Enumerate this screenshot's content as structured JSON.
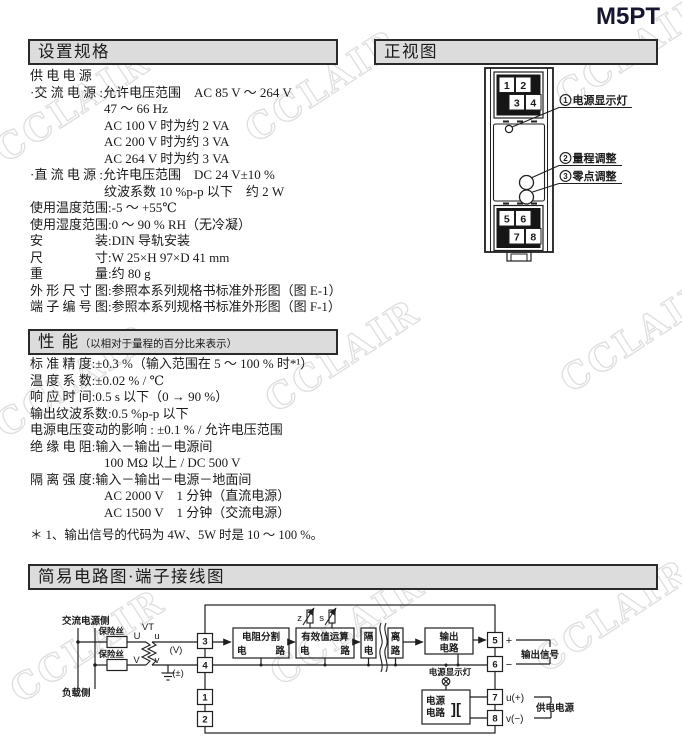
{
  "page": {
    "model": "M5PT"
  },
  "watermark": {
    "text": "CCLAIR"
  },
  "spec": {
    "header": "设置规格",
    "lines": [
      {
        "ind": 0,
        "t": "供 电 电 源"
      },
      {
        "ind": 0,
        "t": "·交 流 电 源 :允许电压范围　AC 85 V ～ 264 V"
      },
      {
        "ind": 1,
        "t": "47 ～ 66 Hz"
      },
      {
        "ind": 1,
        "t": "AC 100 V 时为约 2 VA"
      },
      {
        "ind": 1,
        "t": "AC 200 V 时为约 3 VA"
      },
      {
        "ind": 1,
        "t": "AC 264 V 时为约 3 VA"
      },
      {
        "ind": 0,
        "t": "·直 流 电 源 :允许电压范围　DC 24 V±10 %"
      },
      {
        "ind": 1,
        "t": "纹波系数 10 %p-p 以下　约 2 W"
      },
      {
        "ind": 0,
        "t": "使用温度范围:-5 ～ +55℃"
      },
      {
        "ind": 0,
        "t": "使用湿度范围:0 ～ 90 % RH（无冷凝）"
      },
      {
        "ind": 0,
        "t": "安　　　　装:DIN 导轨安装"
      },
      {
        "ind": 0,
        "t": "尺　　　　寸:W 25×H 97×D 41 mm"
      },
      {
        "ind": 0,
        "t": "重　　　　量:约 80 g"
      },
      {
        "ind": 0,
        "t": "外 形 尺 寸 图:参照本系列规格书标准外形图（图 E-1）"
      },
      {
        "ind": 0,
        "t": "端 子 编 号 图:参照本系列规格书标准外形图（图 F-1）"
      }
    ]
  },
  "performance": {
    "header": "性 能",
    "header_note": "（以相对于量程的百分比来表示）",
    "lines": [
      {
        "ind": 0,
        "t": "标 准 精 度:±0.3 %（输入范围在 5 ～ 100 % 时*¹）"
      },
      {
        "ind": 0,
        "t": "温 度 系 数:±0.02 % / ℃"
      },
      {
        "ind": 0,
        "t": "响 应 时 间:0.5 s 以下（0 → 90 %）"
      },
      {
        "ind": 0,
        "t": "输出纹波系数:0.5 %p-p 以下"
      },
      {
        "ind": 0,
        "t": "电源电压变动的影响 : ±0.1 % / 允许电压范围"
      },
      {
        "ind": 0,
        "t": "绝 缘 电 阻:输入－输出－电源间"
      },
      {
        "ind": 1,
        "t": "100 MΩ 以上 / DC 500 V"
      },
      {
        "ind": 0,
        "t": "隔 离 强 度:输入－输出－电源－地面间"
      },
      {
        "ind": 1,
        "t": "AC 2000 V　1 分钟（直流电源）"
      },
      {
        "ind": 1,
        "t": "AC 1500 V　1 分钟（交流电源）"
      }
    ],
    "footnote": "＊ 1、输出信号的代码为 4W、5W 时是 10 ～ 100 %。"
  },
  "front_view": {
    "header": "正视图",
    "terminals_top": [
      "1",
      "2",
      "3",
      "4"
    ],
    "terminals_bottom": [
      "5",
      "6",
      "7",
      "8"
    ],
    "callouts": [
      {
        "num": "1",
        "label": "电源显示灯"
      },
      {
        "num": "2",
        "label": "量程调整"
      },
      {
        "num": "3",
        "label": "零点调整"
      }
    ]
  },
  "circuit": {
    "header": "简易电路图·端子接线图",
    "labels": {
      "ac_side": "交流电源侧",
      "load_side": "负载侧",
      "fuse_top": "保险丝",
      "fuse_bottom": "保险丝",
      "vt": "VT",
      "u_cap": "U",
      "v_cap": "V",
      "u_low": "u",
      "v_low": "v",
      "volt": "(V)",
      "pm": "(±)",
      "z": "z",
      "s": "s",
      "lamp": "电源显示灯",
      "plus": "+",
      "minus": "−",
      "out_signal": "输出信号",
      "u_plus": "u(+)",
      "v_minus": "v(−)",
      "supply": "供电电源",
      "pwr_symbol": "]["
    },
    "blocks": {
      "divider_l1": "电阻分割",
      "divider_l2": "电路",
      "rms_l1": "有效值运算",
      "rms_l2": "电路",
      "iso_a1": "隔",
      "iso_a2": "电",
      "iso_b1": "离",
      "iso_b2": "路",
      "out_l1": "输出",
      "out_l2": "电路",
      "pwr_l1": "电源",
      "pwr_l2": "电路"
    },
    "terminals_left": [
      "3",
      "4",
      "1",
      "2"
    ],
    "terminals_right": [
      "5",
      "6",
      "7",
      "8"
    ]
  }
}
